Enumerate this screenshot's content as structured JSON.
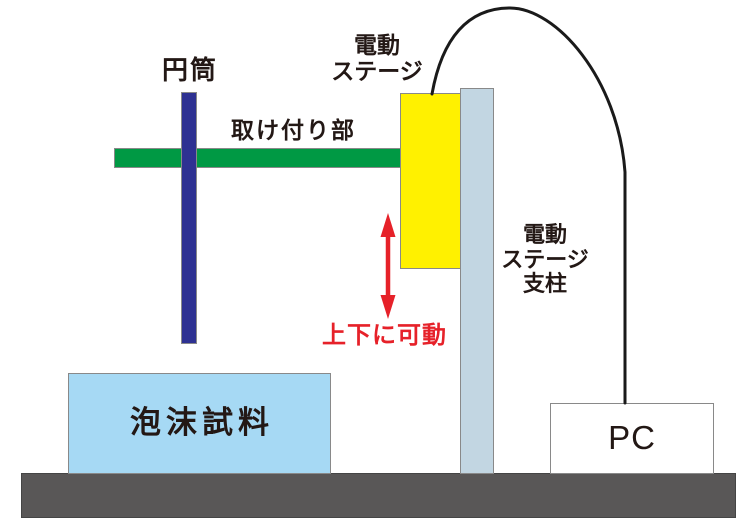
{
  "figure": {
    "type": "experimental-setup-diagram",
    "labels": {
      "cylinder": "円筒",
      "mounting_part": "取け付り部",
      "motor_stage": "電動\nステージ",
      "motor_stage_support": "電動\nステージ\n支柱",
      "movable_up_down": "上下に可動",
      "foam_sample": "泡沫試料",
      "pc": "PC"
    },
    "colors": {
      "cylinder": "#2E3192",
      "mounting_bar": "#009944",
      "motor_stage": "#FFF100",
      "support_column": "#C2D6E2",
      "foam_sample": "#A6D9F4",
      "base": "#595757",
      "annotation_red": "#E62129",
      "cable": "#1A1A1A",
      "outline": "#898989",
      "pc_box": "#FFFFFF",
      "label_text": "#231815"
    }
  }
}
